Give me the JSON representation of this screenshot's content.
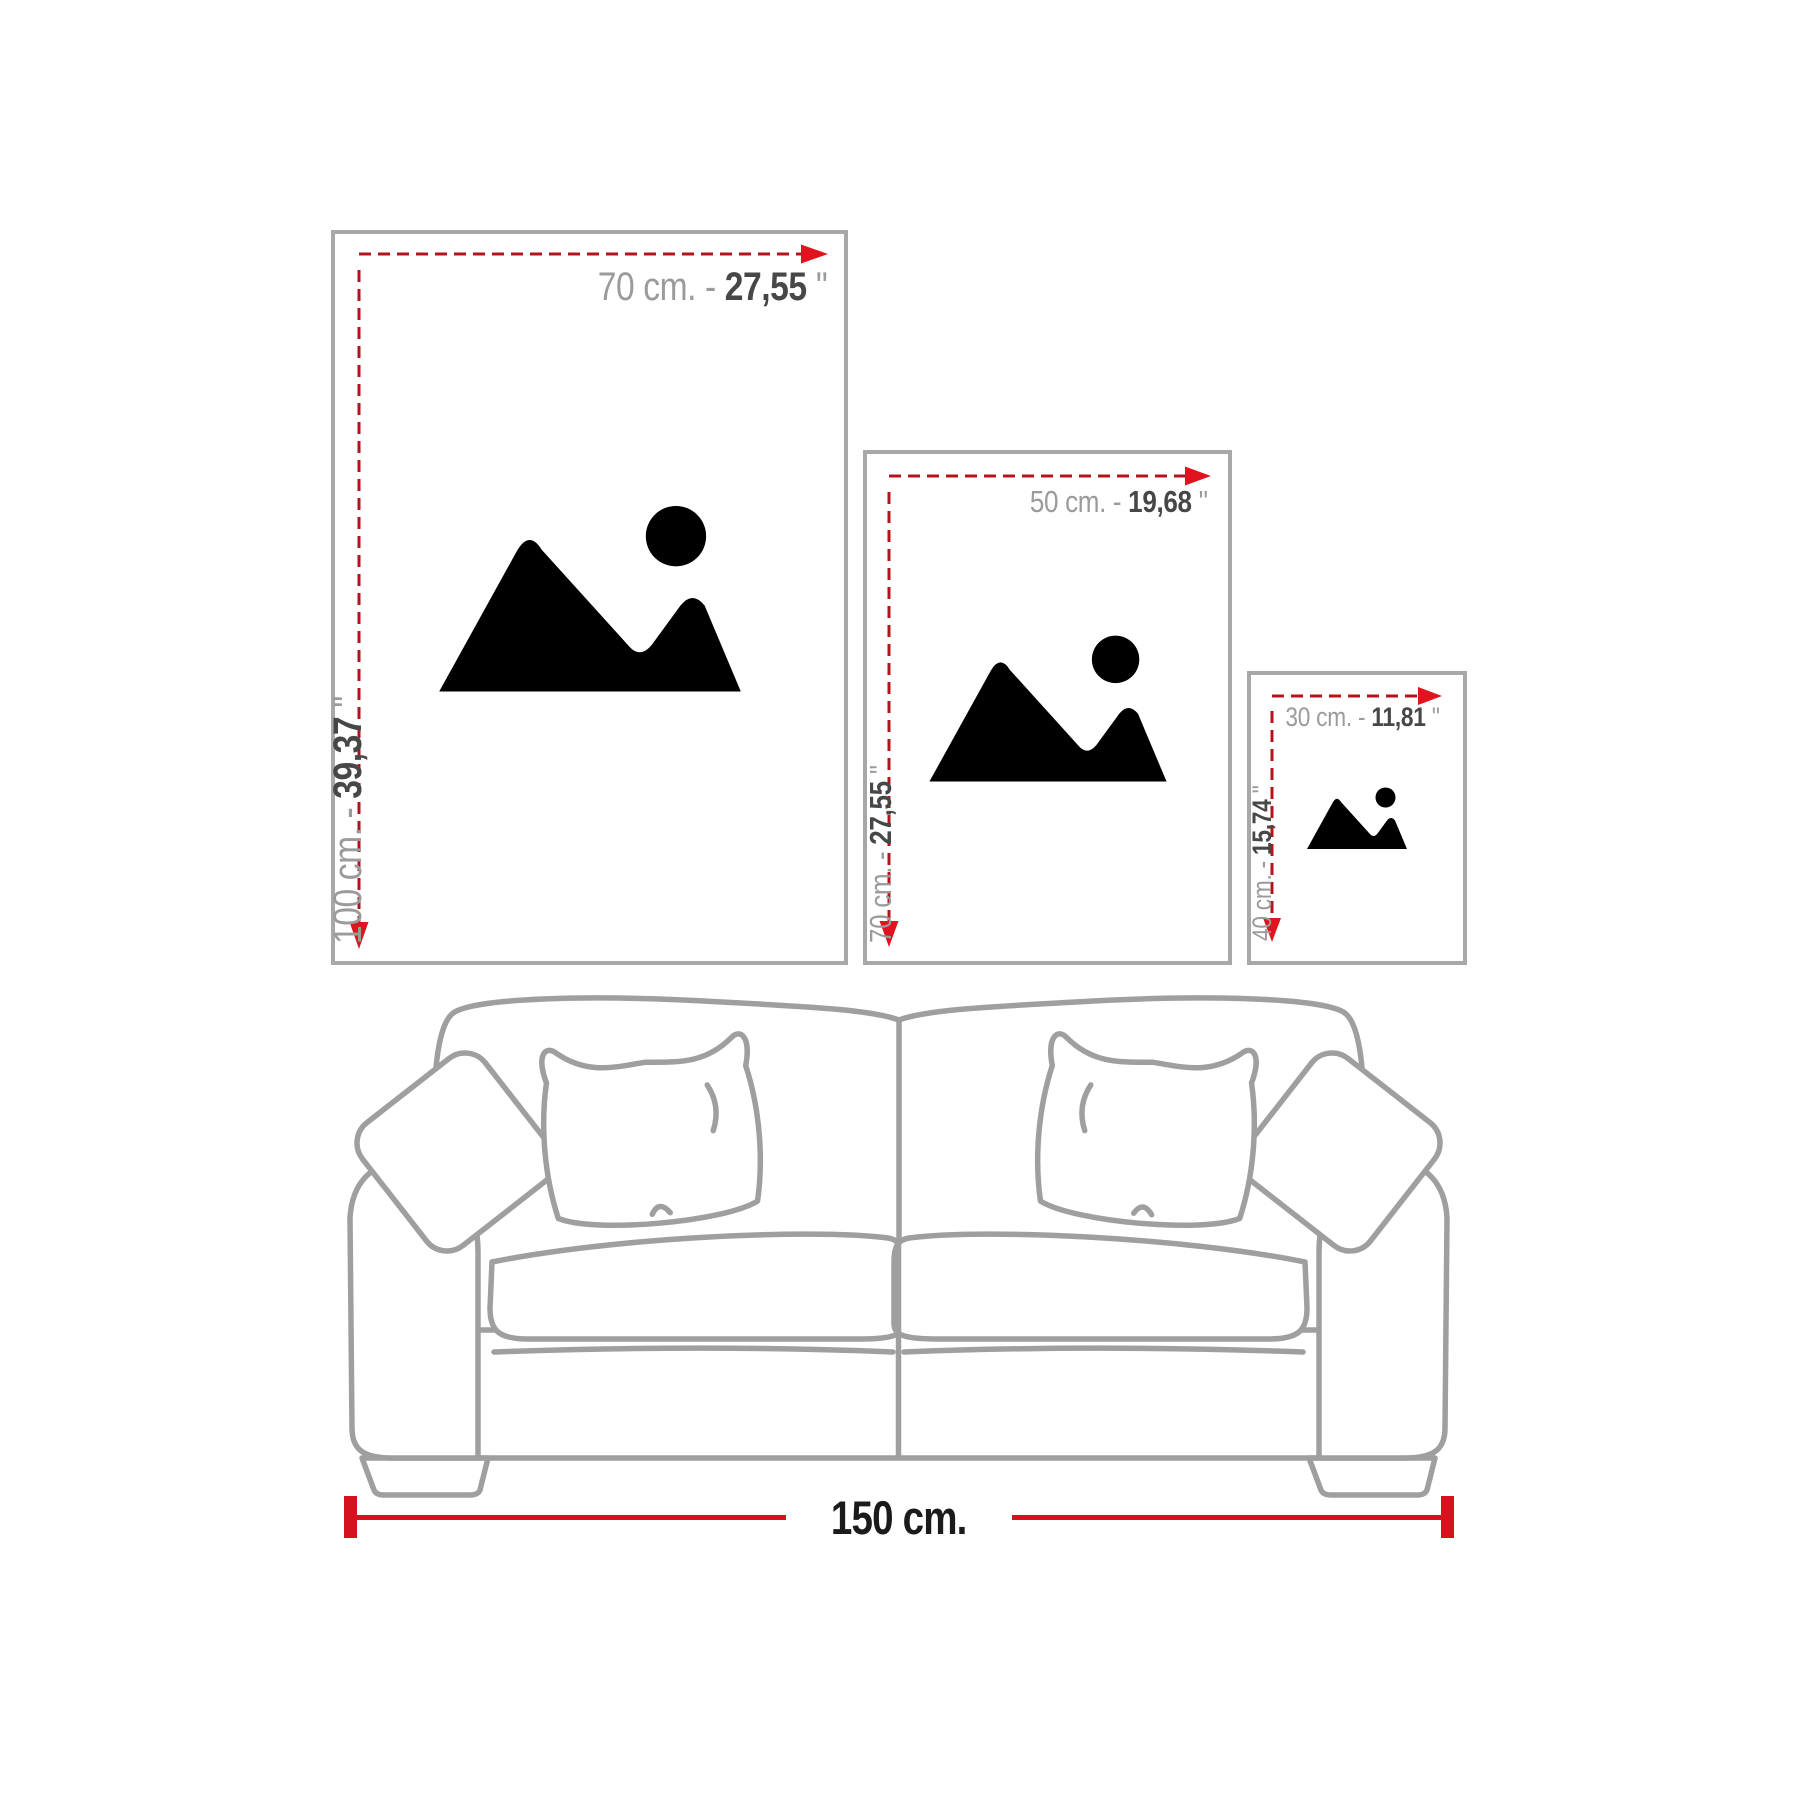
{
  "diagram_title": "wall-art size comparison above sofa",
  "colors": {
    "frame_border": "#a8a8a8",
    "placeholder_gray": "#b0b0b0",
    "dash_red": "#b4131c",
    "arrow_red": "#e0141f",
    "measure_red": "#d6121f",
    "label_gray": "#9b9b9b",
    "label_dark": "#474747",
    "sofa_line": "#9f9f9f",
    "measure_text": "#1b1b1b"
  },
  "separator": " - ",
  "frames": [
    {
      "size_name": "large",
      "width_cm": "70 cm.",
      "width_in": "27,55",
      "height_cm": "100 cm.",
      "height_in": "39,37",
      "inch_mark": " ''"
    },
    {
      "size_name": "medium",
      "width_cm": "50 cm.",
      "width_in": "19,68",
      "height_cm": "70 cm.",
      "height_in": "27,55",
      "inch_mark": " ''"
    },
    {
      "size_name": "small",
      "width_cm": "30 cm.",
      "width_in": "11,81",
      "height_cm": "40 cm.",
      "height_in": "15,74",
      "inch_mark": " ''"
    }
  ],
  "sofa_measure": {
    "label": "150 cm."
  }
}
